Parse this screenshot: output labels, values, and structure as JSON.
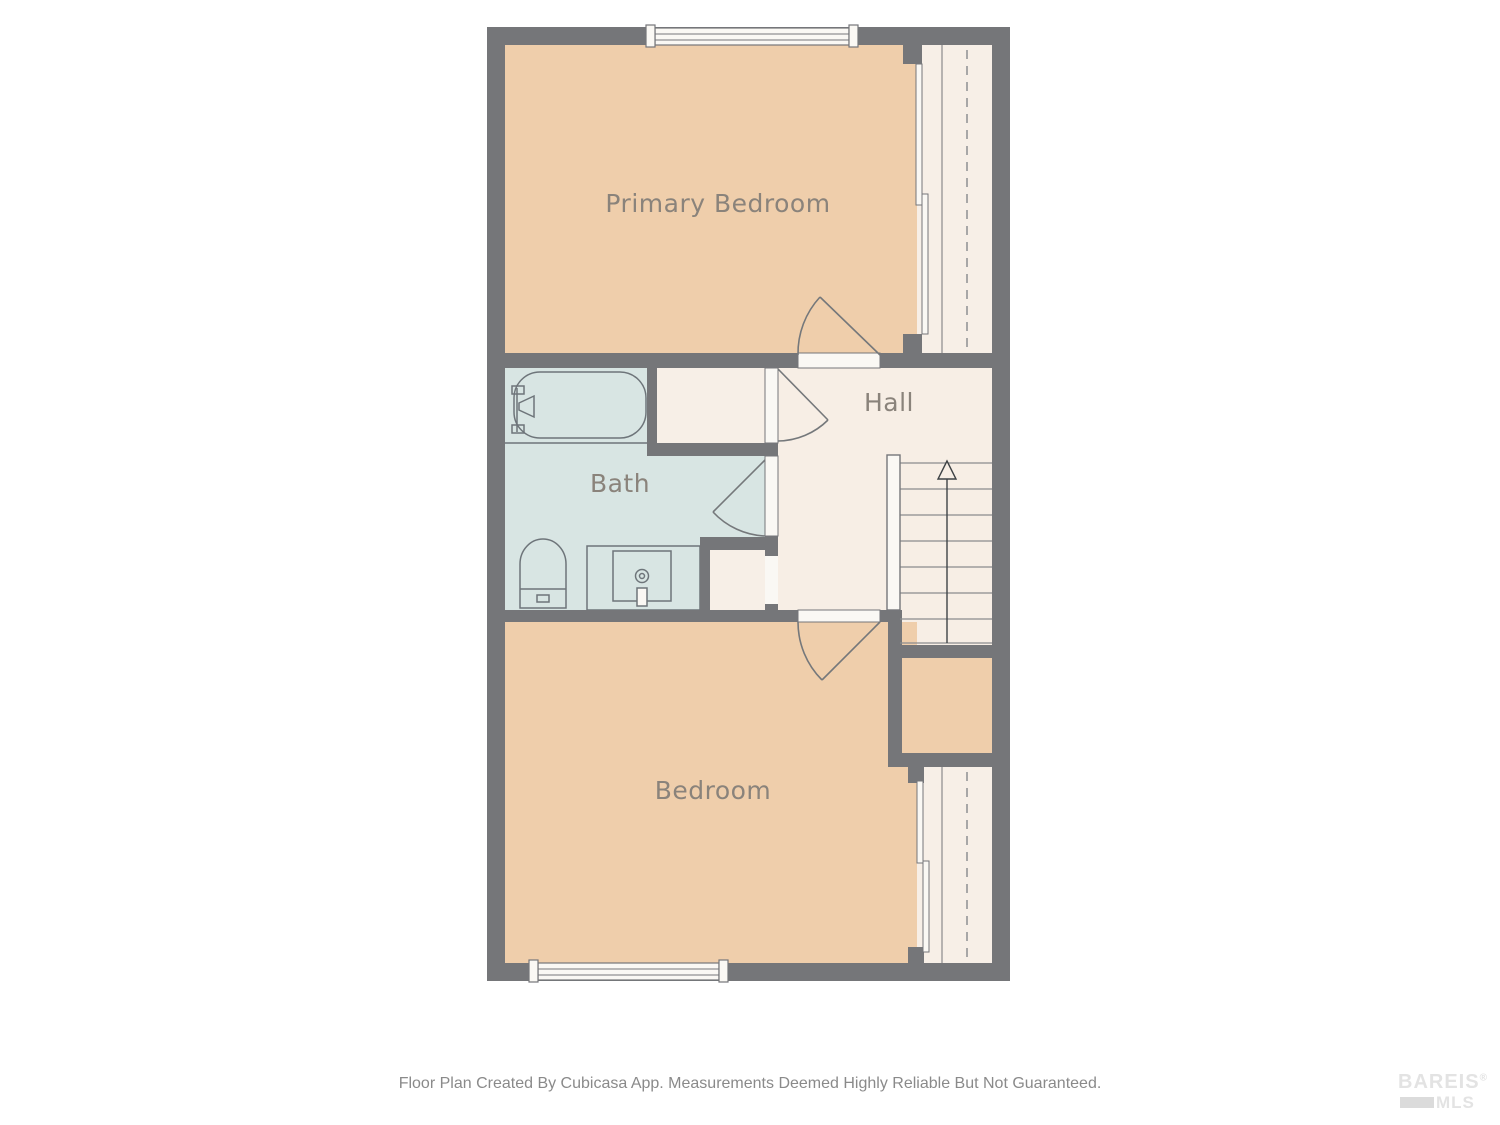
{
  "floor_plan": {
    "rooms": [
      {
        "name": "primary-bedroom",
        "label": "Primary Bedroom"
      },
      {
        "name": "bath",
        "label": "Bath"
      },
      {
        "name": "hall",
        "label": "Hall"
      },
      {
        "name": "bedroom",
        "label": "Bedroom"
      }
    ],
    "stairs": {
      "direction": "up"
    },
    "fixtures": [
      "bathtub",
      "toilet",
      "vanity-sink"
    ],
    "features": [
      "windows",
      "sliding-closet-doors",
      "swing-doors",
      "staircase"
    ]
  },
  "footer": {
    "disclaimer": "Floor Plan Created By Cubicasa App. Measurements Deemed Highly Reliable But Not Guaranteed."
  },
  "watermark": {
    "brand": "BAREIS",
    "registered": "®",
    "suffix": "MLS"
  },
  "colors": {
    "wall": "#757679",
    "bedroom_fill": "#EFCEAB",
    "hall_fill": "#F7EEE5",
    "bath_fill": "#D8E5E3",
    "closet_fill": "#F7EFE7",
    "opening_fill": "#FAF8F4",
    "label_text": "#8A837B",
    "footer_text": "#8A8A8A"
  }
}
